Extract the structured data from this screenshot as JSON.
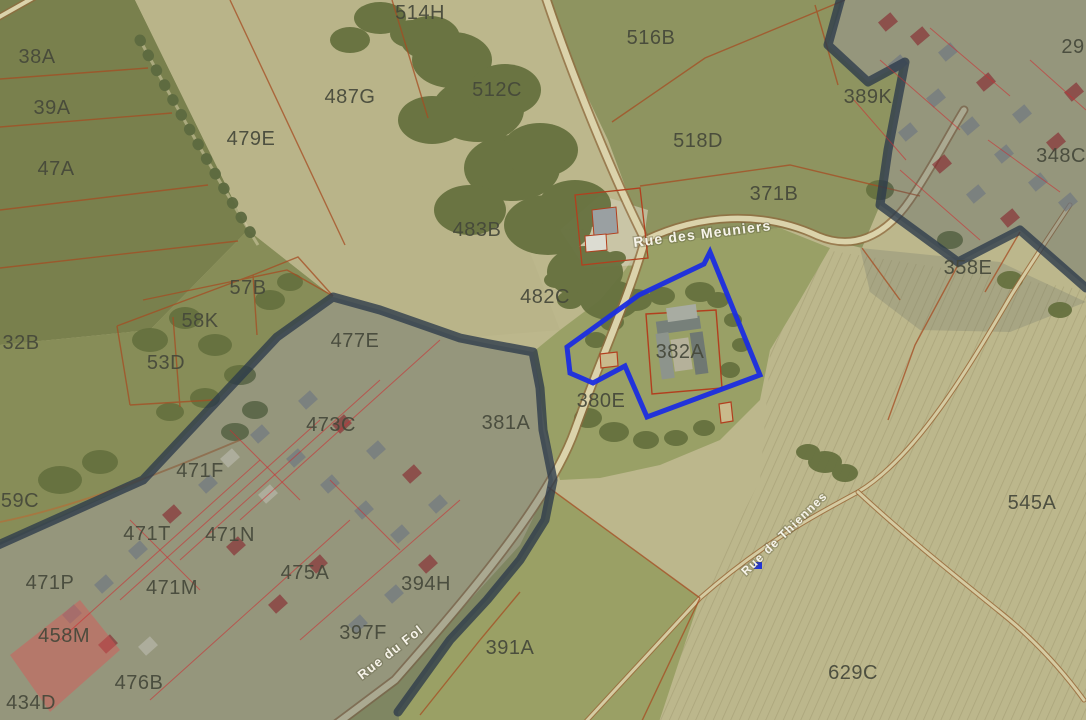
{
  "app": {
    "view_description": "Aerial cadastral parcel map with striped risk-zone overlays and a highlighted subject parcel"
  },
  "map": {
    "subject_parcel": {
      "id": "382A",
      "outline_color": "#1b2de0",
      "vertices": [
        [
          710,
          252
        ],
        [
          704,
          264
        ],
        [
          639,
          295
        ],
        [
          567,
          347
        ],
        [
          570,
          373
        ],
        [
          593,
          383
        ],
        [
          625,
          366
        ],
        [
          647,
          417
        ],
        [
          760,
          375
        ]
      ]
    },
    "marker": {
      "x": 754,
      "y": 562,
      "color": "#2236d6"
    },
    "parcel_labels": [
      {
        "id": "38A",
        "x": 37,
        "y": 56
      },
      {
        "id": "39A",
        "x": 52,
        "y": 107
      },
      {
        "id": "47A",
        "x": 56,
        "y": 168
      },
      {
        "id": "479E",
        "x": 251,
        "y": 138
      },
      {
        "id": "487G",
        "x": 350,
        "y": 96
      },
      {
        "id": "514H",
        "x": 420,
        "y": 12
      },
      {
        "id": "512C",
        "x": 497,
        "y": 89
      },
      {
        "id": "516B",
        "x": 651,
        "y": 37
      },
      {
        "id": "518D",
        "x": 698,
        "y": 140
      },
      {
        "id": "483B",
        "x": 477,
        "y": 229
      },
      {
        "id": "482C",
        "x": 545,
        "y": 296
      },
      {
        "id": "371B",
        "x": 774,
        "y": 193
      },
      {
        "id": "389K",
        "x": 868,
        "y": 96
      },
      {
        "id": "29",
        "x": 1073,
        "y": 46
      },
      {
        "id": "348C",
        "x": 1061,
        "y": 155
      },
      {
        "id": "358E",
        "x": 968,
        "y": 267
      },
      {
        "id": "382A",
        "x": 680,
        "y": 351
      },
      {
        "id": "380E",
        "x": 601,
        "y": 400
      },
      {
        "id": "57B",
        "x": 248,
        "y": 287
      },
      {
        "id": "58K",
        "x": 200,
        "y": 320
      },
      {
        "id": "53D",
        "x": 166,
        "y": 362
      },
      {
        "id": "32B",
        "x": 21,
        "y": 342
      },
      {
        "id": "477E",
        "x": 355,
        "y": 340
      },
      {
        "id": "473C",
        "x": 331,
        "y": 424
      },
      {
        "id": "381A",
        "x": 506,
        "y": 422
      },
      {
        "id": "471F",
        "x": 200,
        "y": 470
      },
      {
        "id": "59C",
        "x": 20,
        "y": 500
      },
      {
        "id": "471T",
        "x": 147,
        "y": 533
      },
      {
        "id": "471N",
        "x": 230,
        "y": 534
      },
      {
        "id": "471P",
        "x": 50,
        "y": 582
      },
      {
        "id": "471M",
        "x": 172,
        "y": 587
      },
      {
        "id": "475A",
        "x": 305,
        "y": 572
      },
      {
        "id": "458M",
        "x": 64,
        "y": 635
      },
      {
        "id": "394H",
        "x": 426,
        "y": 583
      },
      {
        "id": "397F",
        "x": 363,
        "y": 632
      },
      {
        "id": "391A",
        "x": 510,
        "y": 647
      },
      {
        "id": "476B",
        "x": 139,
        "y": 682
      },
      {
        "id": "434D",
        "x": 31,
        "y": 702
      },
      {
        "id": "545A",
        "x": 1032,
        "y": 502
      },
      {
        "id": "629C",
        "x": 853,
        "y": 672
      }
    ],
    "street_labels": [
      {
        "name": "Rue des Meuniers",
        "x": 634,
        "y": 247,
        "rotation": -7,
        "size": 14
      },
      {
        "name": "Rue du Fol",
        "x": 362,
        "y": 680,
        "rotation": -38,
        "size": 13
      },
      {
        "name": "Rue de Thiennes",
        "x": 746,
        "y": 576,
        "rotation": -44,
        "size": 12
      }
    ],
    "overlay_zones": [
      {
        "id": "village-zone-northeast",
        "style": "red-slate-diagonal-stripes"
      },
      {
        "id": "village-zone-southwest",
        "style": "red-slate-diagonal-stripes"
      }
    ],
    "colors": {
      "field_dark": "#79804d",
      "field_mid": "#878d58",
      "field_khaki": "#bcb78c",
      "field_green": "#8e9460",
      "parcel_line": "#a64c22",
      "road_fill": "#dbd3ab",
      "road_casing": "#8f6a3d",
      "zone_border": "rgba(44,58,74,0.78)",
      "zone_stripe_red": "rgba(175,28,38,0.53)",
      "zone_stripe_slate": "rgba(128,140,152,0.50)",
      "subject_outline": "#1b2de0",
      "parcel_label_color": "#45483a",
      "street_label_color": "#f7f4ea"
    }
  }
}
